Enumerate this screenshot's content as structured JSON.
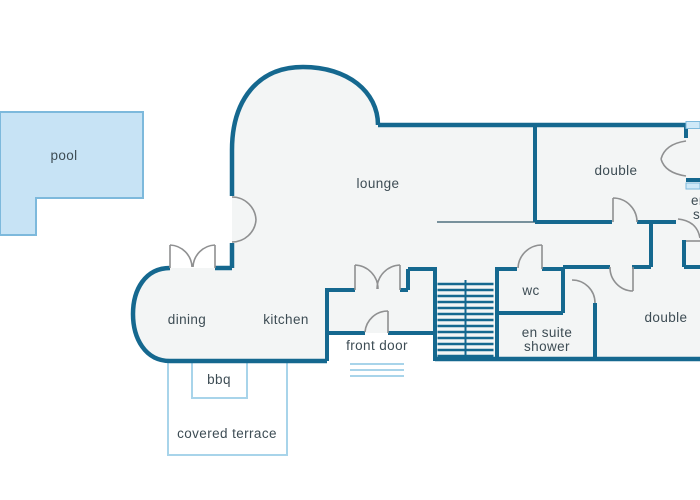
{
  "floorplan": {
    "labels": {
      "pool": "pool",
      "lounge": "lounge",
      "double_upper": "double",
      "double_lower": "double",
      "dining": "dining",
      "kitchen": "kitchen",
      "front_door": "front door",
      "wc": "wc",
      "ensuite_shower_line1": "en suite",
      "ensuite_shower_line2": "shower",
      "clipped_ensuite_line1": "en suite",
      "clipped_ensuite_line2": "shower",
      "bbq": "bbq",
      "covered_terrace": "covered terrace"
    },
    "colors": {
      "wall": "#15688f",
      "room_fill": "#f3f5f5",
      "pool_fill": "#c7e3f5",
      "pool_border": "#7db9dc",
      "outdoor": "#a8d4ea",
      "window_fill": "#cfe9f8",
      "door": "#8f9091",
      "text": "#3d4c54",
      "divider": "#50707f"
    }
  }
}
